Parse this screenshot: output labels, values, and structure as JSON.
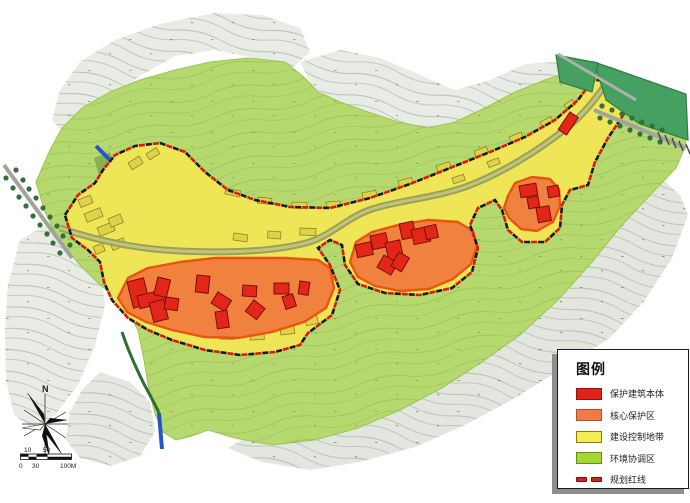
{
  "legend": {
    "title": "图例",
    "items": [
      {
        "label": "保护建筑本体",
        "type": "swatch",
        "color": "#e02318",
        "border": "#9c0f07"
      },
      {
        "label": "核心保护区",
        "type": "swatch",
        "color": "#ef7a4a",
        "border": "#c14c1a"
      },
      {
        "label": "建设控制地带",
        "type": "swatch",
        "color": "#f2ee52",
        "border": "#99770a"
      },
      {
        "label": "环境协调区",
        "type": "swatch",
        "color": "#a5d72f",
        "border": "#5f9110"
      },
      {
        "label": "规划红线",
        "type": "dashed-line",
        "color": "#d82015",
        "border": "#7a0b05"
      }
    ]
  },
  "compass": {
    "north_label": "N"
  },
  "scale_bar": {
    "upper_labels": [
      "10",
      "50"
    ],
    "lower_labels": [
      "0",
      "30",
      "100M"
    ]
  },
  "colors": {
    "protected_building": "#e22718",
    "core_protection": "#f0813f",
    "construction_control": "#eee657",
    "environment_coordination": "#b6d96f",
    "planning_red_line": "#e01808",
    "terrain_grey": "#e8ece4",
    "river_olive": "#99a153",
    "field_green": "#45a062",
    "stream_green": "#2f6e33",
    "water_blue": "#2257c8",
    "road_grey": "#a2a39d"
  }
}
